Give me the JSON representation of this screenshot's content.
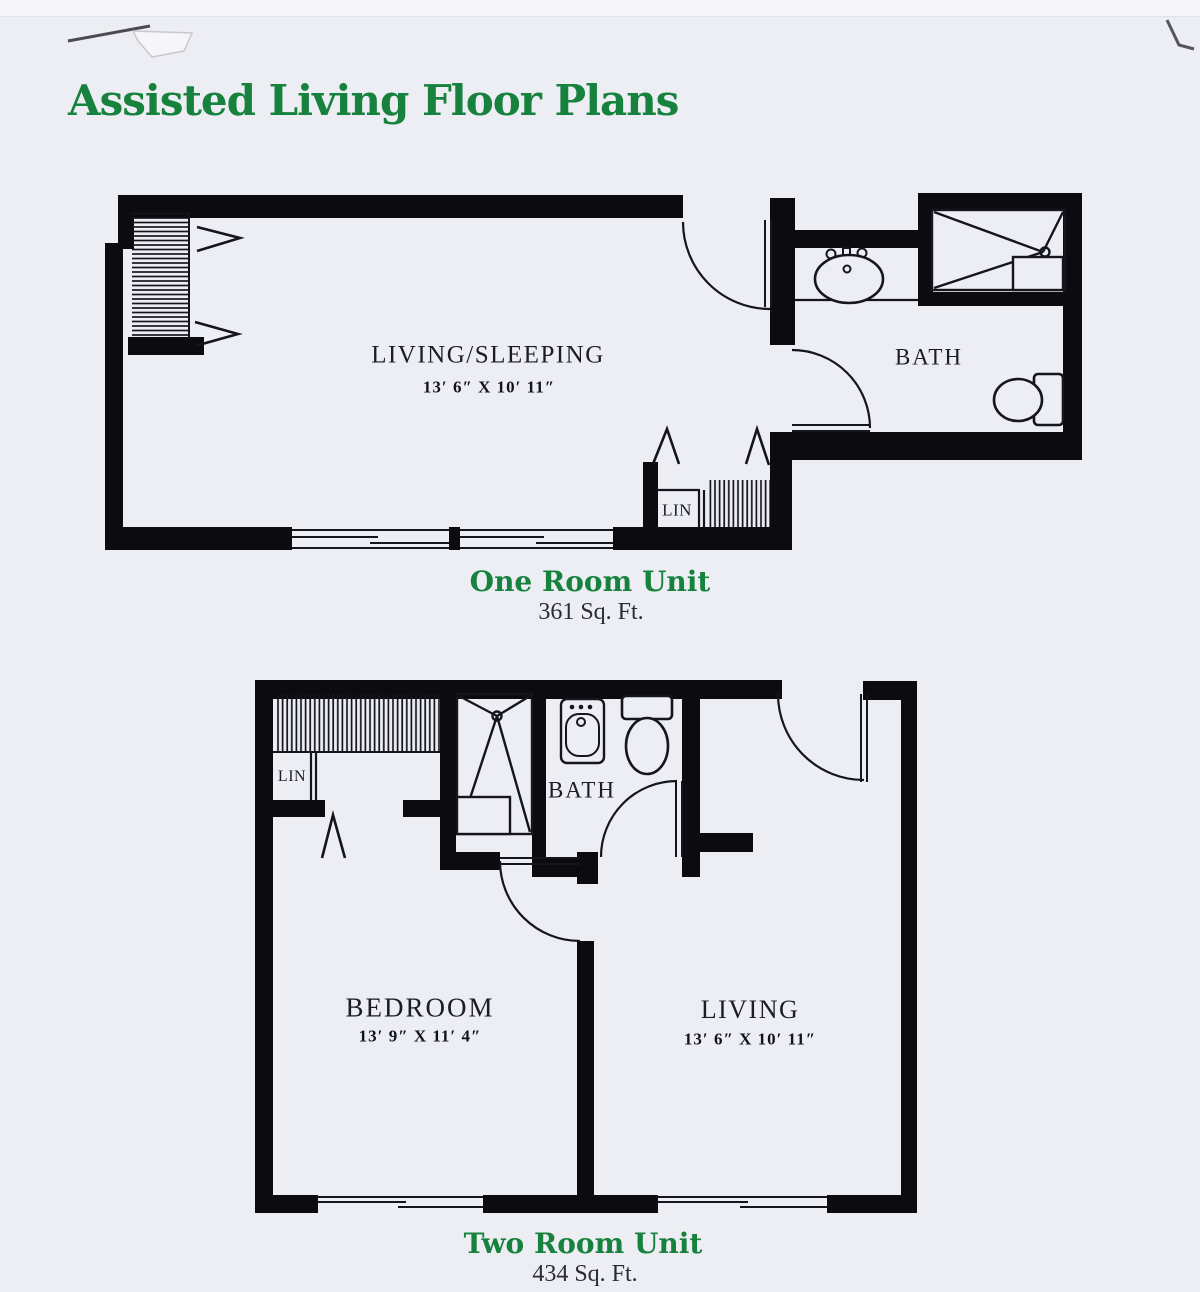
{
  "title": "Assisted Living Floor Plans",
  "plan_one": {
    "caption": "One Room Unit",
    "area": "361 Sq. Ft.",
    "rooms": {
      "living_sleeping": {
        "label": "LIVING/SLEEPING",
        "dims": "13′ 6″ X 10′ 11″"
      },
      "bath": {
        "label": "BATH"
      },
      "linen": {
        "label": "LIN"
      }
    }
  },
  "plan_two": {
    "caption": "Two Room Unit",
    "area": "434 Sq. Ft.",
    "rooms": {
      "bedroom": {
        "label": "BEDROOM",
        "dims": "13′ 9″ X 11′ 4″"
      },
      "living": {
        "label": "LIVING",
        "dims": "13′ 6″ X 10′ 11″"
      },
      "bath": {
        "label": "BATH"
      },
      "linen": {
        "label": "LIN"
      }
    }
  },
  "colors": {
    "accent_green": "#17823e",
    "wall_ink": "#0b0b10",
    "paper": "#edeef3"
  }
}
